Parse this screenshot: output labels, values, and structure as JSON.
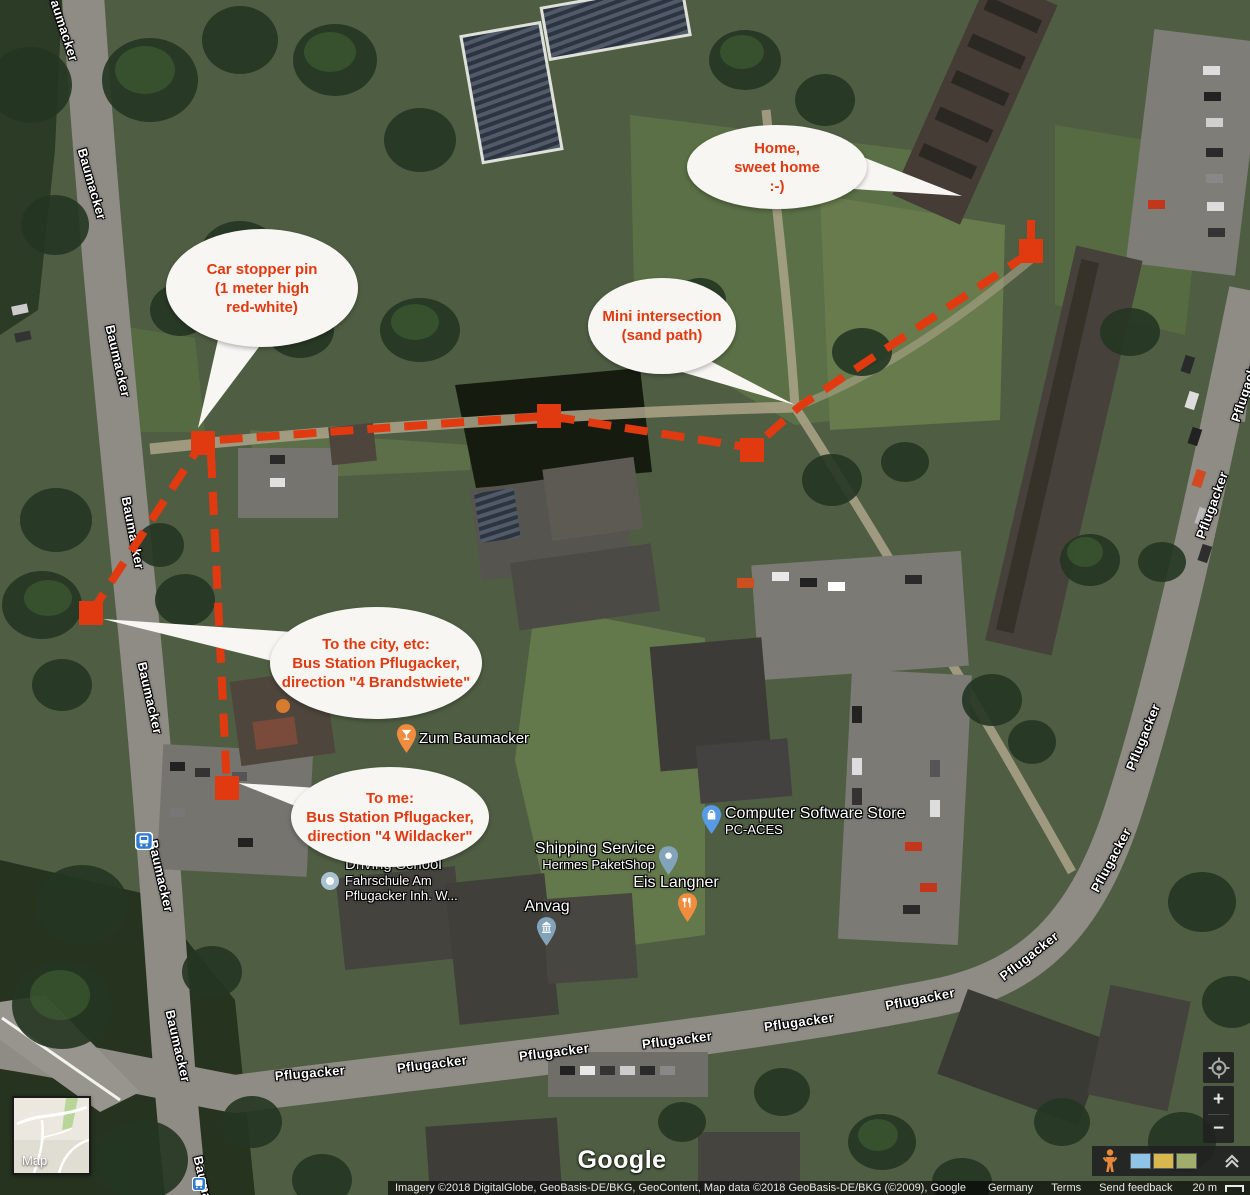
{
  "theme": {
    "accent-red": "#e23a10",
    "bubble-bg": "#f7f6f3",
    "pin-orange": "#f08c3e",
    "pin-blue": "#579be4",
    "pin-slate": "#83a3ba",
    "poi-text": "#ffffff",
    "panel-dark": "rgba(32,32,32,.88)"
  },
  "streets": {
    "baumacker": "Baumacker",
    "pflugacker": "Pflugacker"
  },
  "bubbles": {
    "home": {
      "lines": [
        "Home,",
        "sweet home",
        ":-)"
      ]
    },
    "car_stopper": {
      "lines": [
        "Car stopper pin",
        "(1 meter high",
        "red-white)"
      ]
    },
    "mini_intersection": {
      "lines": [
        "Mini intersection",
        "(sand path)"
      ]
    },
    "to_city": {
      "lines": [
        "To the city, etc:",
        "Bus Station Pflugacker,",
        "direction \"4 Brandstwiete\""
      ]
    },
    "to_me": {
      "lines": [
        "To me:",
        "Bus Station Pflugacker,",
        "direction \"4 Wildacker\""
      ]
    }
  },
  "pois": {
    "zum_baumacker": {
      "name": "Zum Baumacker"
    },
    "computer_store": {
      "name": "Computer Software Store",
      "sub": "PC-ACES"
    },
    "shipping": {
      "name": "Shipping Service",
      "sub": "Hermes PaketShop"
    },
    "eis": {
      "name": "Eis Langner"
    },
    "anvag": {
      "name": "Anvag"
    },
    "driving_school": {
      "name": "Driving School",
      "sub1": "Fahrschule Am",
      "sub2": "Pflugacker Inh. W..."
    }
  },
  "controls": {
    "map_toggle_label": "Map",
    "zoom_in": "+",
    "zoom_out": "−"
  },
  "icons": {
    "bus_stop": "bus-glyph",
    "pegman": "street-view-person",
    "my_location": "target-circle",
    "collapse": "double-chevron-up",
    "cocktail_pin": "bar",
    "restaurant_pin": "fork-knife",
    "shopping_pin": "shopping-bag",
    "bank_pin": "columned-building",
    "parcel_pin": "parcel-dot",
    "poi_dot": "small-circle"
  },
  "footer": {
    "logo": "Google",
    "attribution": "Imagery ©2018 DigitalGlobe, GeoBasis-DE/BKG, GeoContent, Map data ©2018 GeoBasis-DE/BKG (©2009), Google",
    "links": [
      "Germany",
      "Terms",
      "Send feedback"
    ],
    "scale_label": "20 m"
  }
}
